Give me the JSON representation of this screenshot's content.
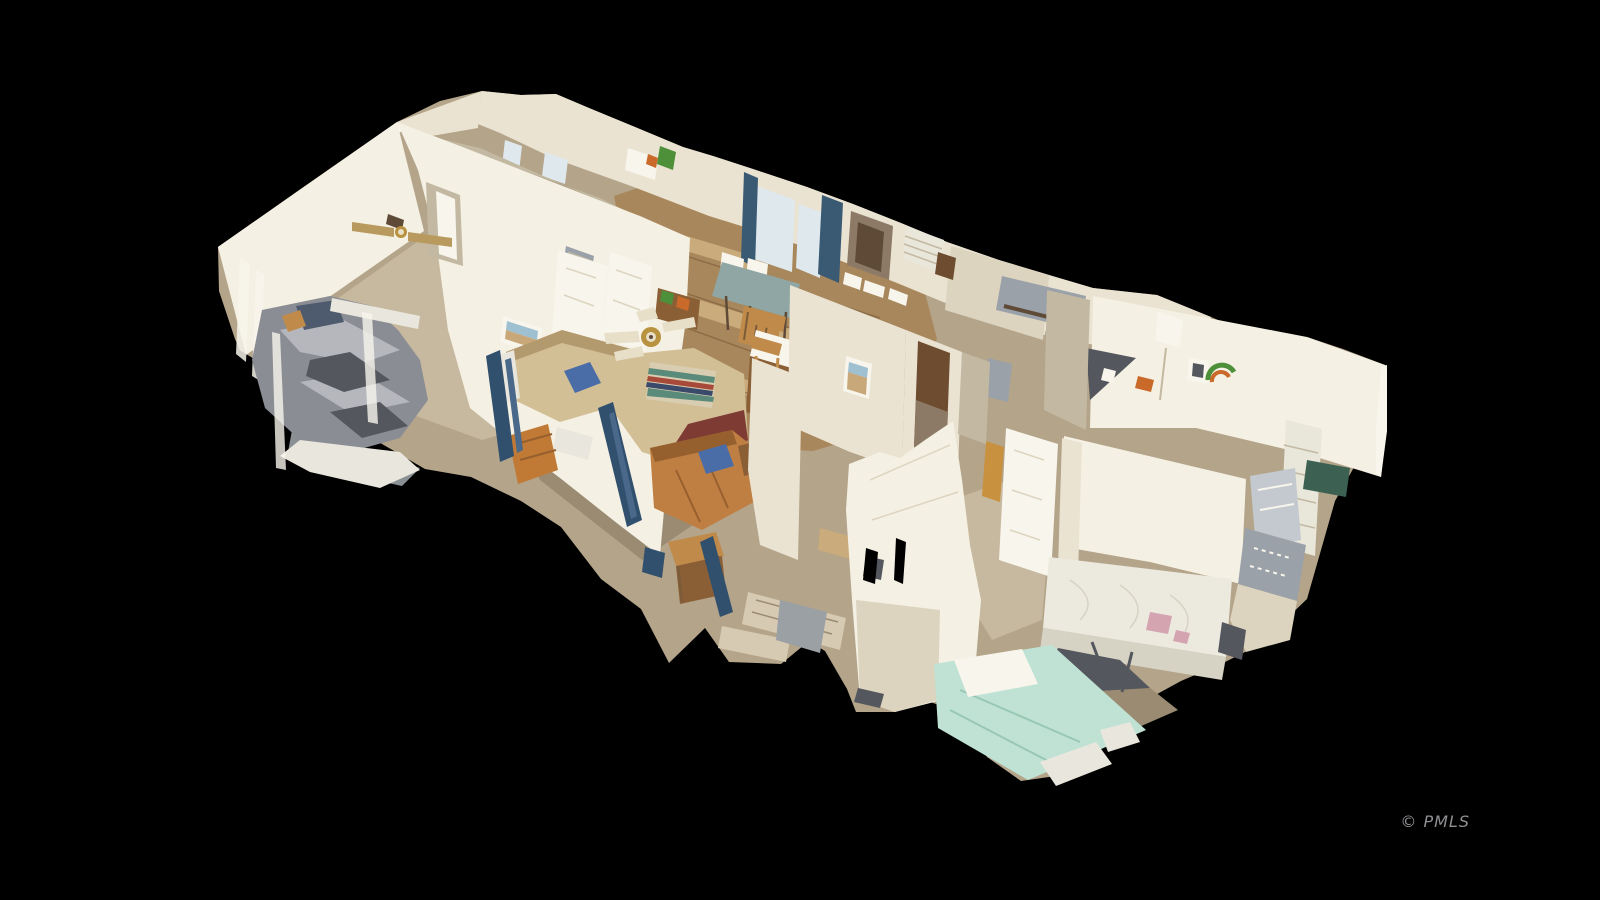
{
  "canvas": {
    "width": 1600,
    "height": 900,
    "background": "#000000"
  },
  "watermark": {
    "text": "© PMLS",
    "color": "#8f9094",
    "font_size": 16
  },
  "scene": {
    "type": "3d-dollhouse-scan-render",
    "rooms": [
      "left-bedroom",
      "living-room",
      "kitchen-dining",
      "hallway",
      "bathroom",
      "right-bedroom",
      "far-right-bedroom"
    ],
    "objects": [
      "gray-draped-bed",
      "ceiling-fan-bedroom",
      "ceiling-fan-living",
      "tan-armchair",
      "serape-draped-couch",
      "leather-sofa",
      "dining-table",
      "kitchen-island",
      "bar-stool",
      "blue-curtain-windows",
      "wood-wall-cabinet",
      "brown-hallway-door",
      "open-white-door",
      "bare-mattress",
      "mint-green-bed",
      "rainbow-wall-art",
      "framed-picture-beach",
      "framed-picture-desert",
      "window-shutter-blinds",
      "patterned-rug"
    ]
  },
  "palette": {
    "background": "#000000",
    "wall_bright": "#f4f0e3",
    "wall_light": "#eae3d2",
    "wall_mid": "#dcd4bf",
    "wall_shadow": "#c3b9a2",
    "wall_white": "#f8f5ec",
    "carpet": "#b3a48a",
    "carpet_light": "#c7b99f",
    "carpet_dark": "#9a8b72",
    "wood_floor": "#a8875c",
    "wood_light": "#c9ab7c",
    "wood_dark": "#7c5c38",
    "wood_lit": "#c8913f",
    "bed_gray": "#8b8d94",
    "bed_gray_light": "#b5b7bd",
    "bed_gray_dark": "#55575e",
    "pillow_navy": "#4e5a6e",
    "headboard_white": "#e9e7dd",
    "couch_tan": "#d3bf96",
    "couch_tan_dark": "#b29a6e",
    "couch_maroon": "#7e3b33",
    "pillow_blue": "#4a6da8",
    "serape_cream": "#d8cdb0",
    "serape_teal": "#5a8a7a",
    "serape_red": "#a84a3a",
    "serape_navy": "#3a4a6a",
    "leather": "#c07f42",
    "leather_dark": "#96602e",
    "wood_furniture": "#8a5f36",
    "orange_cabinet": "#c07a35",
    "table_teal": "#8fa6a4",
    "chair_oak": "#c08b4a",
    "cabinet_brown": "#8d7a66",
    "cabinet_brown_dark": "#5f4a38",
    "door_brown": "#6e4c30",
    "curtain_blue": "#3a5a74",
    "window_pale": "#dfe8ec",
    "blinds_white": "#e9e6da",
    "picture_sky": "#9ec0d0",
    "picture_tan": "#c8a878",
    "mint": "#bfe2d4",
    "mint_dark": "#98c8b4",
    "mattress": "#eceade",
    "mattress_shadow": "#d6d3c4",
    "stain_pink": "#d4a4b0",
    "silver_bed": "#c4c9cf",
    "green_dark": "#3c6152",
    "rug_gray": "#9aa1a8",
    "rug_light": "#d6cab2",
    "fan_gold": "#b8923f",
    "fan_blade": "#e8dfc8",
    "fan_blade_tan": "#b89a5e",
    "artifact_blue": "#31506e",
    "artifact_blue2": "#49688a",
    "green_item": "#4e8f3a",
    "orange_item": "#c96a2a",
    "fuzz_gray": "#9aa0a4",
    "black": "#000000"
  }
}
